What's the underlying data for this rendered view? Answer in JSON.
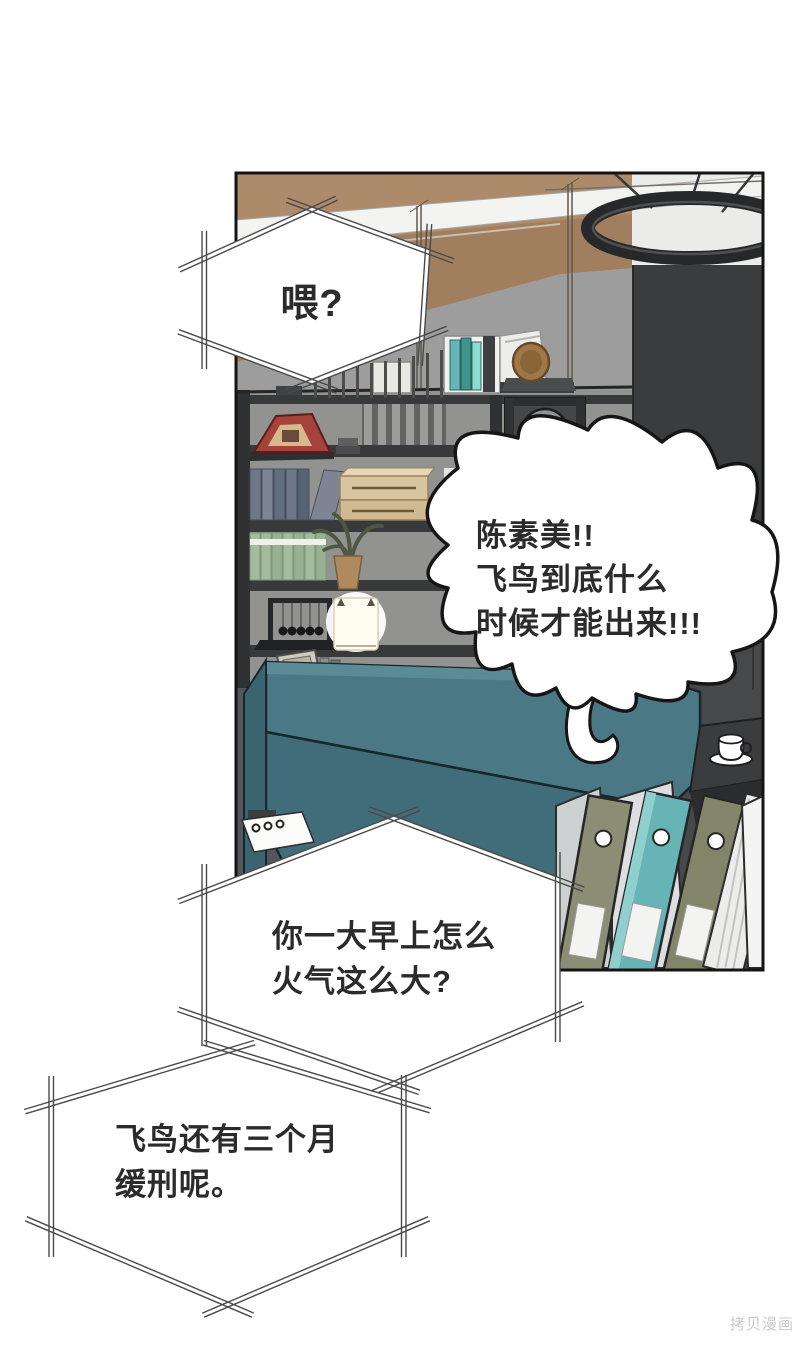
{
  "bubbles": {
    "b1": {
      "lines": [
        "喂?"
      ]
    },
    "b2": {
      "lines": [
        "陈素美!!",
        "飞鸟到底什么",
        "时候才能出来!!!"
      ]
    },
    "b3": {
      "lines": [
        "你一大早上怎么",
        "火气这么大?"
      ]
    },
    "b4": {
      "lines": [
        "飞鸟还有三个月",
        "缓刑呢。"
      ]
    }
  },
  "watermark": {
    "text": "拷贝漫画"
  },
  "colors": {
    "page_bg": "#ffffff",
    "panel_outline": "#141414",
    "wall_tan": "#ad8a69",
    "wall_tan_dark": "#a17f5e",
    "wall_gray": "#9d9d9d",
    "ceiling_white": "#ebebe9",
    "beam_white": "#f3f3f1",
    "column_dark": "#3a3c3e",
    "column_mid": "#464849",
    "shelf_frame": "#37393b",
    "sofa_teal": "#4a7884",
    "sofa_seat": "#406d79",
    "floor_dark": "#53565a",
    "desk_dark": "#3a3c3d",
    "binder_olive": "#8b8d75",
    "binder_teal": "#66b4b6",
    "books_blue": "#6d7787",
    "books_green": "#a4bb9e",
    "box_tan": "#d8c5a0",
    "frame_red": "#a6423c",
    "disc_bronze": "#a07848",
    "bubble_fill": "#ffffff",
    "bubble_line": "#4a4a4a",
    "shout_outline": "#161616",
    "text_color": "#2b2b2b",
    "watermark_color": "#c9c9c9"
  }
}
